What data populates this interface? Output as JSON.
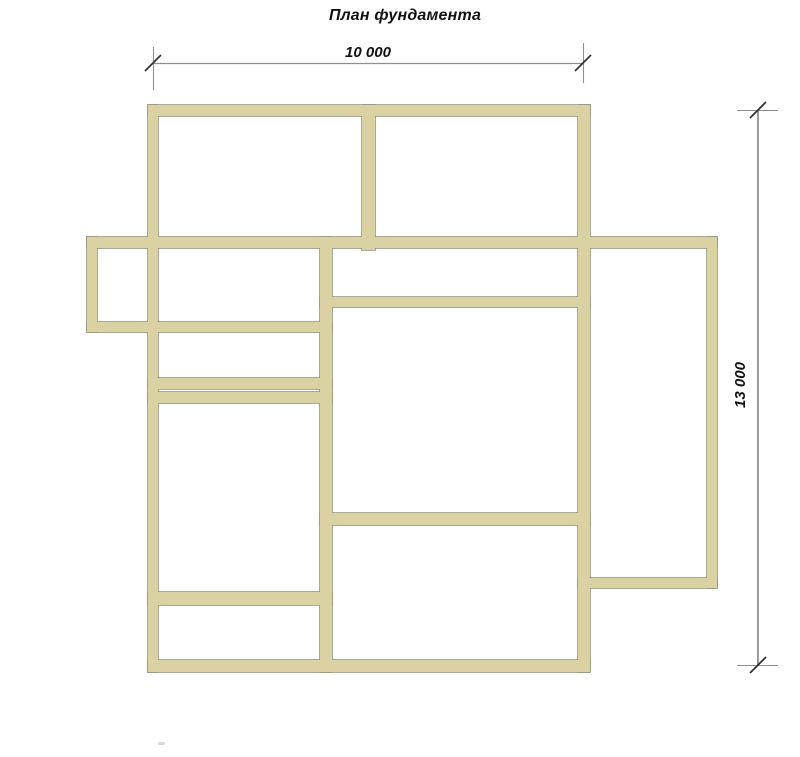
{
  "title": "План фундамента",
  "dimensions": {
    "width_label": "10 000",
    "height_label": "13 000"
  },
  "colors": {
    "background": "#ffffff",
    "wall_fill": "#dbd2a4",
    "wall_outline": "#8e8b73",
    "dim_line": "#8f8f8f",
    "tick_slash": "#2f2f2f",
    "label_text": "#121212"
  },
  "plan": {
    "walls": [
      {
        "id": "top",
        "x": 148,
        "y": 105,
        "w": 442,
        "h": 11
      },
      {
        "id": "mid",
        "x": 87,
        "y": 237,
        "w": 630,
        "h": 11
      },
      {
        "id": "right-room-bottom",
        "x": 320,
        "y": 297,
        "w": 270,
        "h": 10
      },
      {
        "id": "left-extension-bottom",
        "x": 87,
        "y": 322,
        "w": 245,
        "h": 10
      },
      {
        "id": "small-room-bottom",
        "x": 148,
        "y": 378,
        "w": 184,
        "h": 11
      },
      {
        "id": "tall-room-top",
        "x": 148,
        "y": 392,
        "w": 184,
        "h": 11
      },
      {
        "id": "big-room-bottom",
        "x": 320,
        "y": 513,
        "w": 270,
        "h": 12
      },
      {
        "id": "right-extension-bottom",
        "x": 578,
        "y": 578,
        "w": 139,
        "h": 10
      },
      {
        "id": "tall-room-bottom",
        "x": 148,
        "y": 592,
        "w": 184,
        "h": 13
      },
      {
        "id": "bottom",
        "x": 148,
        "y": 660,
        "w": 442,
        "h": 12
      },
      {
        "id": "left",
        "x": 148,
        "y": 105,
        "w": 10,
        "h": 567
      },
      {
        "id": "left-extension-left",
        "x": 87,
        "y": 237,
        "w": 10,
        "h": 95
      },
      {
        "id": "middle-vertical",
        "x": 320,
        "y": 237,
        "w": 12,
        "h": 435
      },
      {
        "id": "top-divider",
        "x": 362,
        "y": 105,
        "w": 13,
        "h": 145
      },
      {
        "id": "right",
        "x": 578,
        "y": 105,
        "w": 12,
        "h": 567
      },
      {
        "id": "right-extension-right",
        "x": 707,
        "y": 237,
        "w": 10,
        "h": 351
      }
    ]
  }
}
